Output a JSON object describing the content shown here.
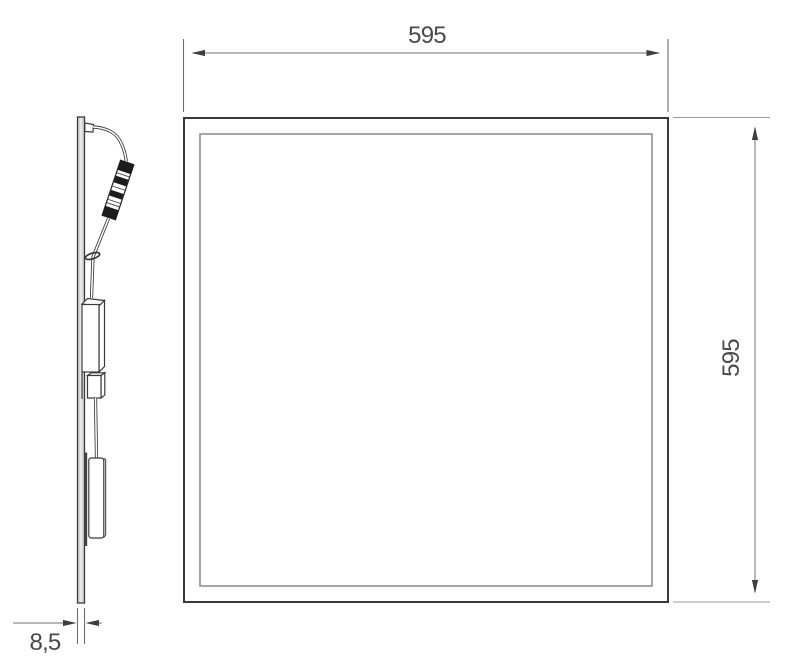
{
  "drawing": {
    "type": "technical-dimension-drawing",
    "subject": "led-panel-light",
    "views": {
      "front_view": "panel front face with frame and diffuser",
      "side_view": "panel edge profile with cable, connector, driver"
    },
    "dimensions": {
      "width": "595",
      "height": "595",
      "thickness": "8,5"
    },
    "colors": {
      "background": "#ffffff",
      "main_line": "#3a3a3a",
      "frame_line": "#383838",
      "inner_line": "#8f8f8f",
      "dimension_line": "#8c8c8c",
      "extension_line": "#9a9a9a",
      "arrow": "#3f3f3f",
      "label_text": "#4a4a4a",
      "panel_fill": "#d6d6d6",
      "connector_band": "#1c1c1c"
    }
  }
}
